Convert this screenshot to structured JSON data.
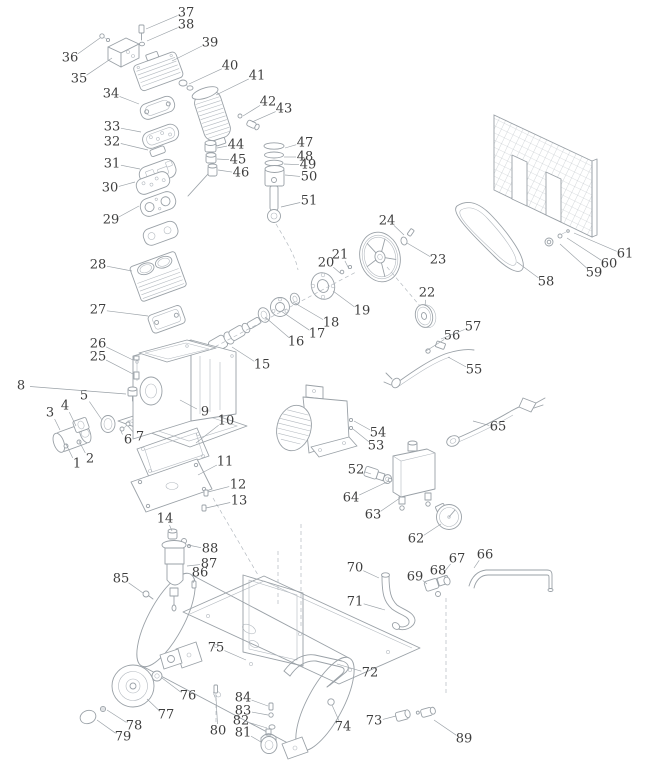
{
  "meta": {
    "description": "Exploded parts diagram of a belt-driven air compressor with numbered callouts 1-89"
  },
  "style": {
    "line_color": "#9aa1a7",
    "line_color_light": "#b4bac0",
    "label_color": "#3e3e3e",
    "background": "#ffffff"
  },
  "labels": [
    {
      "n": "1",
      "x": 77,
      "y": 464,
      "tx": 66,
      "ty": 444
    },
    {
      "n": "2",
      "x": 90,
      "y": 459,
      "tx": 79,
      "ty": 441
    },
    {
      "n": "3",
      "x": 50,
      "y": 413,
      "tx": 60,
      "ty": 430
    },
    {
      "n": "4",
      "x": 65,
      "y": 406,
      "tx": 76,
      "ty": 426
    },
    {
      "n": "5",
      "x": 84,
      "y": 396,
      "tx": 102,
      "ty": 420
    },
    {
      "n": "6",
      "x": 128,
      "y": 440,
      "tx": 121,
      "ty": 431
    },
    {
      "n": "7",
      "x": 140,
      "y": 437,
      "tx": 128,
      "ty": 426
    },
    {
      "n": "8",
      "x": 21,
      "y": 386,
      "tx": 126,
      "ty": 394
    },
    {
      "n": "9",
      "x": 205,
      "y": 412,
      "tx": 180,
      "ty": 400
    },
    {
      "n": "10",
      "x": 226,
      "y": 421,
      "tx": 196,
      "ty": 443
    },
    {
      "n": "11",
      "x": 225,
      "y": 462,
      "tx": 198,
      "ty": 475
    },
    {
      "n": "12",
      "x": 238,
      "y": 485,
      "tx": 208,
      "ty": 492
    },
    {
      "n": "13",
      "x": 239,
      "y": 501,
      "tx": 206,
      "ty": 508
    },
    {
      "n": "14",
      "x": 165,
      "y": 519,
      "tx": 172,
      "ty": 531
    },
    {
      "n": "15",
      "x": 262,
      "y": 365,
      "tx": 232,
      "ty": 347
    },
    {
      "n": "16",
      "x": 296,
      "y": 342,
      "tx": 265,
      "ty": 317
    },
    {
      "n": "17",
      "x": 317,
      "y": 334,
      "tx": 281,
      "ty": 311
    },
    {
      "n": "18",
      "x": 331,
      "y": 323,
      "tx": 293,
      "ty": 302
    },
    {
      "n": "19",
      "x": 362,
      "y": 311,
      "tx": 333,
      "ty": 291
    },
    {
      "n": "20",
      "x": 326,
      "y": 263,
      "tx": 340,
      "ty": 273
    },
    {
      "n": "21",
      "x": 340,
      "y": 255,
      "tx": 349,
      "ty": 269
    },
    {
      "n": "22",
      "x": 427,
      "y": 293,
      "tx": 425,
      "ty": 306
    },
    {
      "n": "23",
      "x": 438,
      "y": 260,
      "tx": 407,
      "ty": 243
    },
    {
      "n": "24",
      "x": 387,
      "y": 221,
      "tx": 404,
      "ty": 235
    },
    {
      "n": "25",
      "x": 98,
      "y": 357,
      "tx": 133,
      "ty": 374
    },
    {
      "n": "26",
      "x": 98,
      "y": 344,
      "tx": 133,
      "ty": 360
    },
    {
      "n": "27",
      "x": 98,
      "y": 310,
      "tx": 148,
      "ty": 316
    },
    {
      "n": "28",
      "x": 98,
      "y": 265,
      "tx": 132,
      "ty": 271
    },
    {
      "n": "29",
      "x": 111,
      "y": 220,
      "tx": 139,
      "ty": 206
    },
    {
      "n": "30",
      "x": 110,
      "y": 188,
      "tx": 135,
      "ty": 182
    },
    {
      "n": "31",
      "x": 112,
      "y": 164,
      "tx": 140,
      "ty": 169
    },
    {
      "n": "32",
      "x": 112,
      "y": 142,
      "tx": 148,
      "ty": 150
    },
    {
      "n": "33",
      "x": 112,
      "y": 127,
      "tx": 141,
      "ty": 132
    },
    {
      "n": "34",
      "x": 111,
      "y": 94,
      "tx": 139,
      "ty": 104
    },
    {
      "n": "35",
      "x": 79,
      "y": 79,
      "tx": 112,
      "ty": 58
    },
    {
      "n": "36",
      "x": 70,
      "y": 58,
      "tx": 100,
      "ty": 38
    },
    {
      "n": "37",
      "x": 186,
      "y": 13,
      "tx": 146,
      "ty": 29
    },
    {
      "n": "38",
      "x": 186,
      "y": 25,
      "tx": 147,
      "ty": 41
    },
    {
      "n": "39",
      "x": 210,
      "y": 43,
      "tx": 172,
      "ty": 61
    },
    {
      "n": "40",
      "x": 230,
      "y": 66,
      "tx": 189,
      "ty": 84
    },
    {
      "n": "41",
      "x": 257,
      "y": 76,
      "tx": 216,
      "ty": 95
    },
    {
      "n": "42",
      "x": 268,
      "y": 102,
      "tx": 243,
      "ty": 116
    },
    {
      "n": "43",
      "x": 284,
      "y": 109,
      "tx": 252,
      "ty": 122
    },
    {
      "n": "44",
      "x": 236,
      "y": 145,
      "tx": 217,
      "ty": 148
    },
    {
      "n": "45",
      "x": 238,
      "y": 160,
      "tx": 217,
      "ty": 159
    },
    {
      "n": "46",
      "x": 241,
      "y": 173,
      "tx": 218,
      "ty": 170
    },
    {
      "n": "47",
      "x": 305,
      "y": 143,
      "tx": 285,
      "ty": 148
    },
    {
      "n": "48",
      "x": 305,
      "y": 157,
      "tx": 284,
      "ty": 157
    },
    {
      "n": "49",
      "x": 308,
      "y": 165,
      "tx": 284,
      "ty": 164
    },
    {
      "n": "50",
      "x": 309,
      "y": 177,
      "tx": 285,
      "ty": 175
    },
    {
      "n": "51",
      "x": 309,
      "y": 201,
      "tx": 281,
      "ty": 207
    },
    {
      "n": "52",
      "x": 356,
      "y": 470,
      "tx": 371,
      "ty": 474
    },
    {
      "n": "53",
      "x": 376,
      "y": 446,
      "tx": 353,
      "ty": 429
    },
    {
      "n": "54",
      "x": 378,
      "y": 433,
      "tx": 354,
      "ty": 421
    },
    {
      "n": "55",
      "x": 474,
      "y": 370,
      "tx": 448,
      "ty": 357
    },
    {
      "n": "56",
      "x": 452,
      "y": 336,
      "tx": 426,
      "ty": 351
    },
    {
      "n": "57",
      "x": 473,
      "y": 327,
      "tx": 441,
      "ty": 339
    },
    {
      "n": "58",
      "x": 546,
      "y": 282,
      "tx": 517,
      "ty": 262
    },
    {
      "n": "59",
      "x": 594,
      "y": 273,
      "tx": 560,
      "ty": 244
    },
    {
      "n": "60",
      "x": 609,
      "y": 264,
      "tx": 567,
      "ty": 238
    },
    {
      "n": "61",
      "x": 625,
      "y": 254,
      "tx": 574,
      "ty": 233
    },
    {
      "n": "62",
      "x": 416,
      "y": 539,
      "tx": 441,
      "ty": 524
    },
    {
      "n": "63",
      "x": 373,
      "y": 515,
      "tx": 400,
      "ty": 498
    },
    {
      "n": "64",
      "x": 351,
      "y": 498,
      "tx": 389,
      "ty": 481
    },
    {
      "n": "65",
      "x": 498,
      "y": 427,
      "tx": 473,
      "ty": 421
    },
    {
      "n": "66",
      "x": 485,
      "y": 555,
      "tx": 474,
      "ty": 568
    },
    {
      "n": "67",
      "x": 457,
      "y": 559,
      "tx": 445,
      "ty": 571
    },
    {
      "n": "68",
      "x": 438,
      "y": 571,
      "tx": 437,
      "ty": 579
    },
    {
      "n": "69",
      "x": 415,
      "y": 577,
      "tx": 427,
      "ty": 584
    },
    {
      "n": "70",
      "x": 355,
      "y": 568,
      "tx": 379,
      "ty": 578
    },
    {
      "n": "71",
      "x": 355,
      "y": 602,
      "tx": 385,
      "ty": 610
    },
    {
      "n": "72",
      "x": 370,
      "y": 673,
      "tx": 337,
      "ty": 664
    },
    {
      "n": "73",
      "x": 374,
      "y": 721,
      "tx": 396,
      "ty": 716
    },
    {
      "n": "74",
      "x": 343,
      "y": 727,
      "tx": 332,
      "ty": 705
    },
    {
      "n": "75",
      "x": 216,
      "y": 648,
      "tx": 246,
      "ty": 660
    },
    {
      "n": "76",
      "x": 188,
      "y": 696,
      "tx": 162,
      "ty": 678
    },
    {
      "n": "77",
      "x": 166,
      "y": 715,
      "tx": 147,
      "ty": 699
    },
    {
      "n": "78",
      "x": 134,
      "y": 726,
      "tx": 107,
      "ty": 710
    },
    {
      "n": "79",
      "x": 123,
      "y": 737,
      "tx": 97,
      "ty": 720
    },
    {
      "n": "80",
      "x": 218,
      "y": 731,
      "tx": 216,
      "ty": 698
    },
    {
      "n": "81",
      "x": 243,
      "y": 733,
      "tx": 261,
      "ty": 742
    },
    {
      "n": "82",
      "x": 241,
      "y": 721,
      "tx": 267,
      "ty": 728
    },
    {
      "n": "83",
      "x": 243,
      "y": 711,
      "tx": 268,
      "ty": 715
    },
    {
      "n": "84",
      "x": 243,
      "y": 698,
      "tx": 268,
      "ty": 706
    },
    {
      "n": "85",
      "x": 121,
      "y": 579,
      "tx": 143,
      "ty": 593
    },
    {
      "n": "86",
      "x": 200,
      "y": 573,
      "tx": 193,
      "ty": 583
    },
    {
      "n": "87",
      "x": 209,
      "y": 564,
      "tx": 187,
      "ty": 566
    },
    {
      "n": "88",
      "x": 210,
      "y": 549,
      "tx": 188,
      "ty": 545
    },
    {
      "n": "89",
      "x": 464,
      "y": 739,
      "tx": 434,
      "ty": 720
    }
  ]
}
